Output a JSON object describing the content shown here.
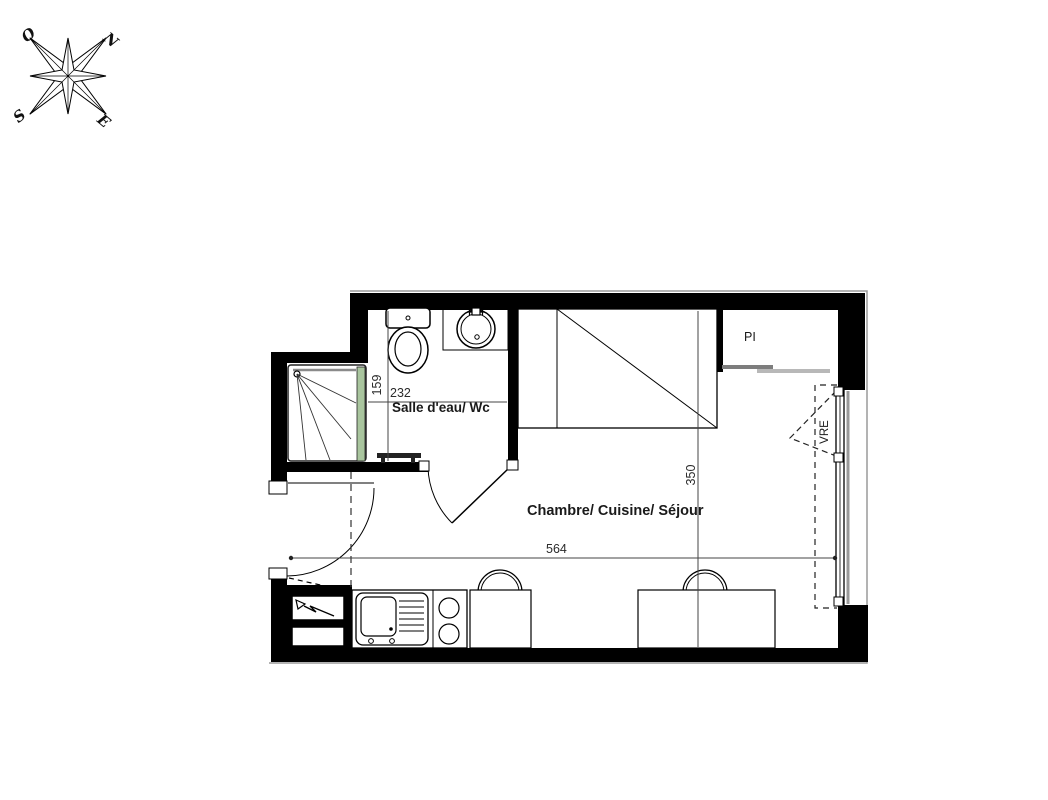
{
  "compass": {
    "north": "N",
    "east": "E",
    "south": "S",
    "west": "O"
  },
  "plan": {
    "bathroom": {
      "label": "Salle d'eau/ Wc",
      "dim_width": "232",
      "dim_depth": "159"
    },
    "main_room": {
      "label": "Chambre/ Cuisine/ Séjour",
      "dim_width": "564",
      "dim_depth": "350"
    },
    "closet": {
      "label": "PI"
    },
    "window": {
      "label": "VRE"
    }
  },
  "colors": {
    "wall": "#000000",
    "shower-glass": "#a9c59e",
    "slider": "#7d7d7d",
    "dim-line": "#444444"
  }
}
